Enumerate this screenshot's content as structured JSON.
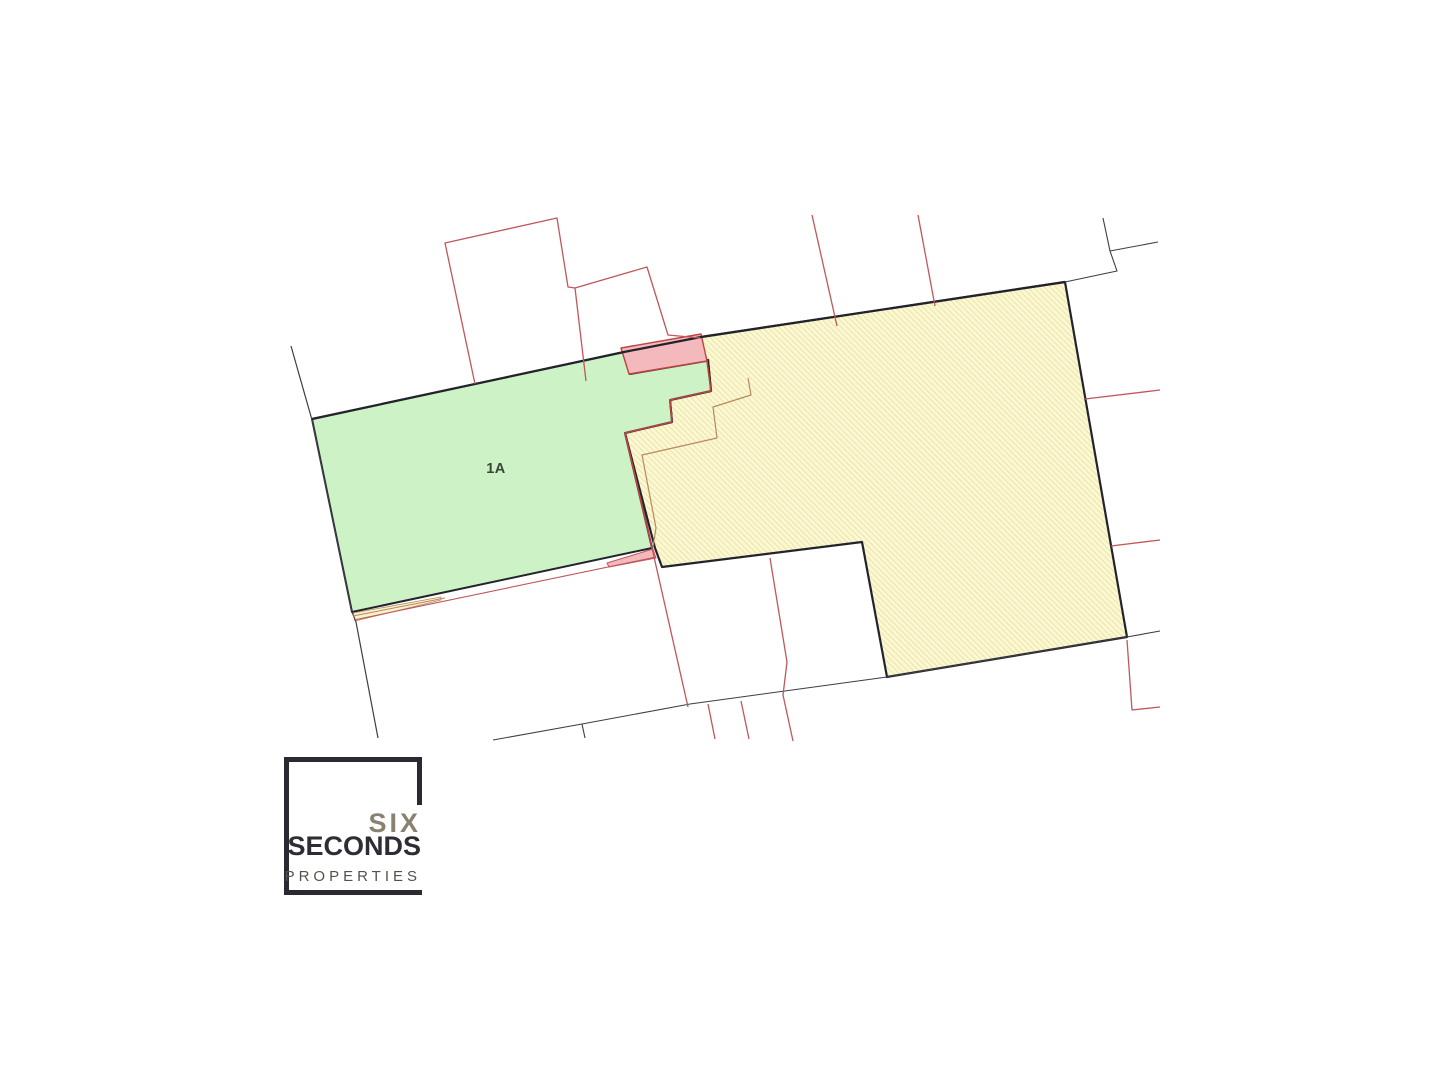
{
  "logo": {
    "line1": "SIX",
    "line2": "SECONDS",
    "line3": "PROPERTIES"
  },
  "map": {
    "label": {
      "text": "1A",
      "x": 496,
      "y": 473,
      "font_size": 14.5
    },
    "palette": {
      "dark": "#23232e",
      "thin_dark": "#3d3d47",
      "red": "#c0575b",
      "red_strong": "#bf4340",
      "orange": "#b98a5f",
      "green_fill": "#ccf2c6",
      "yellow_fill": "#fbf8d2",
      "yellow_hatch": "#e8dfa2",
      "pale_sliver": "#f6f2cf",
      "pink_fill": "#f3b9bd",
      "label": "#38463a"
    },
    "shapes": [
      {
        "name": "parcel-yellow",
        "type": "polygon",
        "fill": "hatch",
        "stroke": "dark",
        "width": 2.2,
        "points": [
          [
            701,
            337
          ],
          [
            1065,
            282
          ],
          [
            1127,
            637
          ],
          [
            887,
            677
          ],
          [
            862,
            542
          ],
          [
            662,
            567
          ],
          [
            655,
            548
          ],
          [
            625,
            433
          ],
          [
            672,
            422
          ],
          [
            670,
            400
          ],
          [
            711,
            391
          ],
          [
            708,
            360
          ],
          [
            706,
            361
          ]
        ]
      },
      {
        "name": "parcel-green-1a",
        "type": "polygon",
        "fill": "green_fill",
        "stroke": "dark",
        "width": 2,
        "points": [
          [
            312,
            419
          ],
          [
            624,
            352
          ],
          [
            630,
            374
          ],
          [
            706,
            361
          ],
          [
            708,
            360
          ],
          [
            711,
            391
          ],
          [
            670,
            400
          ],
          [
            672,
            422
          ],
          [
            625,
            433
          ],
          [
            652,
            548
          ],
          [
            352,
            612
          ]
        ]
      },
      {
        "name": "sliver-yellow-south",
        "type": "polygon",
        "fill": "pale_sliver",
        "stroke": "orange",
        "width": 0.8,
        "points": [
          [
            353,
            613
          ],
          [
            441,
            597
          ],
          [
            441,
            600
          ],
          [
            355,
            621
          ]
        ]
      },
      {
        "name": "sliver-pink-south",
        "type": "polygon",
        "fill": "pink_fill",
        "stroke": "red",
        "width": 1,
        "points": [
          [
            607,
            563
          ],
          [
            653,
            549
          ],
          [
            656,
            558
          ],
          [
            609,
            567
          ]
        ]
      },
      {
        "name": "parcel-pink-north",
        "type": "polygon",
        "fill": "pink_fill",
        "stroke": "red_strong",
        "width": 1.4,
        "points": [
          [
            621,
            348
          ],
          [
            701,
            334
          ],
          [
            707,
            361
          ],
          [
            629,
            374
          ]
        ]
      },
      {
        "name": "boundary-north-main",
        "type": "polyline",
        "stroke": "dark",
        "width": 2.2,
        "points": [
          [
            312,
            419
          ],
          [
            624,
            352
          ],
          [
            701,
            337
          ],
          [
            1065,
            282
          ]
        ]
      },
      {
        "name": "boundary-west",
        "type": "polyline",
        "stroke": "thin_dark",
        "width": 1.2,
        "points": [
          [
            291,
            346
          ],
          [
            312,
            420
          ],
          [
            352,
            612
          ],
          [
            356,
            622
          ],
          [
            378,
            738
          ]
        ]
      },
      {
        "name": "boundary-northeast-corner",
        "type": "polyline",
        "stroke": "thin_dark",
        "width": 1.1,
        "points": [
          [
            1103,
            218
          ],
          [
            1110,
            251
          ],
          [
            1158,
            242
          ]
        ]
      },
      {
        "name": "boundary-northeast-road",
        "type": "polyline",
        "stroke": "thin_dark",
        "width": 1.1,
        "points": [
          [
            1110,
            251
          ],
          [
            1117,
            271
          ],
          [
            1065,
            282
          ]
        ]
      },
      {
        "name": "road-line-south",
        "type": "polyline",
        "stroke": "thin_dark",
        "width": 1.1,
        "points": [
          [
            493,
            740
          ],
          [
            582,
            724
          ],
          [
            690,
            704
          ],
          [
            887,
            677
          ],
          [
            1127,
            637
          ],
          [
            1160,
            631
          ]
        ]
      },
      {
        "name": "road-tick",
        "type": "polyline",
        "stroke": "thin_dark",
        "width": 1.1,
        "points": [
          [
            582,
            724
          ],
          [
            585,
            738
          ]
        ]
      },
      {
        "name": "red-parcel-northwest-large",
        "type": "polyline",
        "stroke": "red",
        "width": 1.3,
        "points": [
          [
            475,
            384
          ],
          [
            445,
            243
          ],
          [
            557,
            218
          ],
          [
            568,
            287
          ],
          [
            575,
            288
          ],
          [
            586,
            381
          ]
        ]
      },
      {
        "name": "red-parcel-northwest-small",
        "type": "polyline",
        "stroke": "red",
        "width": 1.3,
        "points": [
          [
            575,
            288
          ],
          [
            647,
            267
          ],
          [
            668,
            335
          ],
          [
            700,
            338
          ]
        ]
      },
      {
        "name": "red-line-north-1",
        "type": "polyline",
        "stroke": "red",
        "width": 1.3,
        "points": [
          [
            812,
            215
          ],
          [
            837,
            326
          ]
        ]
      },
      {
        "name": "red-line-north-2",
        "type": "polyline",
        "stroke": "red",
        "width": 1.3,
        "points": [
          [
            918,
            215
          ],
          [
            935,
            306
          ]
        ]
      },
      {
        "name": "red-line-east-1",
        "type": "polyline",
        "stroke": "red",
        "width": 1.3,
        "points": [
          [
            1085,
            399
          ],
          [
            1160,
            390
          ]
        ]
      },
      {
        "name": "red-line-east-2",
        "type": "polyline",
        "stroke": "red",
        "width": 1.3,
        "points": [
          [
            1111,
            546
          ],
          [
            1160,
            540
          ]
        ]
      },
      {
        "name": "red-line-southeast",
        "type": "polyline",
        "stroke": "red",
        "width": 1.3,
        "points": [
          [
            1127,
            640
          ],
          [
            1132,
            710
          ],
          [
            1160,
            707
          ]
        ]
      },
      {
        "name": "red-line-center-south",
        "type": "polyline",
        "stroke": "red",
        "width": 1.3,
        "points": [
          [
            770,
            558
          ],
          [
            787,
            662
          ],
          [
            783,
            695
          ],
          [
            793,
            741
          ]
        ]
      },
      {
        "name": "red-line-south-diagonal",
        "type": "polyline",
        "stroke": "red",
        "width": 1.3,
        "points": [
          [
            652,
            548
          ],
          [
            688,
            707
          ]
        ]
      },
      {
        "name": "red-stub-south-1",
        "type": "polyline",
        "stroke": "red",
        "width": 1.3,
        "points": [
          [
            708,
            704
          ],
          [
            715,
            739
          ]
        ]
      },
      {
        "name": "red-stub-south-2",
        "type": "polyline",
        "stroke": "red",
        "width": 1.3,
        "points": [
          [
            741,
            701
          ],
          [
            749,
            739
          ]
        ]
      },
      {
        "name": "red-line-green-south",
        "type": "polyline",
        "stroke": "red",
        "width": 1.1,
        "points": [
          [
            354,
            620
          ],
          [
            656,
            557
          ]
        ]
      },
      {
        "name": "red-staircase-boundary",
        "type": "polyline",
        "stroke": "red_strong",
        "width": 1.6,
        "points": [
          [
            707,
            361
          ],
          [
            711,
            391
          ],
          [
            670,
            400
          ],
          [
            672,
            422
          ],
          [
            625,
            433
          ],
          [
            652,
            548
          ]
        ]
      },
      {
        "name": "orange-staircase-old-boundary",
        "type": "polyline",
        "stroke": "orange",
        "width": 1.2,
        "points": [
          [
            748,
            378
          ],
          [
            751,
            395
          ],
          [
            713,
            407
          ],
          [
            717,
            438
          ],
          [
            642,
            455
          ],
          [
            656,
            528
          ],
          [
            653,
            547
          ]
        ]
      },
      {
        "name": "orange-line-southwest",
        "type": "polyline",
        "stroke": "orange",
        "width": 1,
        "points": [
          [
            353,
            616
          ],
          [
            445,
            598
          ]
        ]
      }
    ]
  }
}
